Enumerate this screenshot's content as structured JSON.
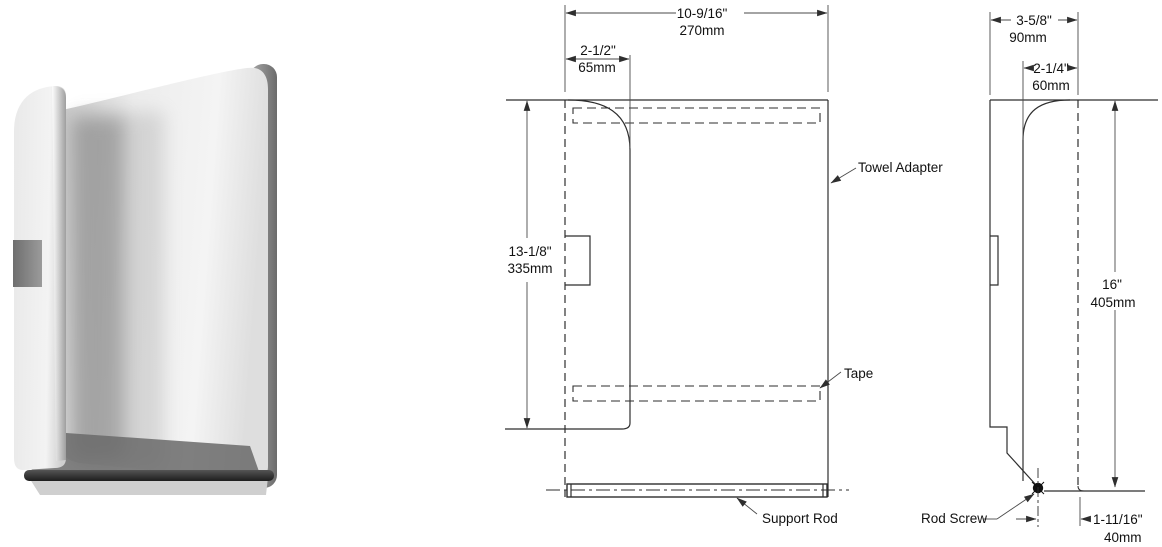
{
  "product_photo": {
    "name": "towel-adapter-product-photo"
  },
  "front_view": {
    "dim_width": {
      "in": "10-9/16\"",
      "mm": "270mm"
    },
    "dim_offset": {
      "in": "2-1/2\"",
      "mm": "65mm"
    },
    "dim_height": {
      "in": "13-1/8\"",
      "mm": "335mm"
    },
    "labels": {
      "towel_adapter": "Towel Adapter",
      "tape": "Tape",
      "support_rod": "Support Rod"
    }
  },
  "side_view": {
    "dim_depth": {
      "in": "3-5/8\"",
      "mm": "90mm"
    },
    "dim_front": {
      "in": "2-1/4\"",
      "mm": "60mm"
    },
    "dim_height": {
      "in": "16\"",
      "mm": "405mm"
    },
    "dim_rod": {
      "in": "1-11/16\"",
      "mm": "40mm"
    },
    "labels": {
      "rod_screw": "Rod Screw"
    }
  },
  "colors": {
    "line": "#2e2e2e",
    "thin_line": "#4a4a4a",
    "text": "#111111"
  }
}
